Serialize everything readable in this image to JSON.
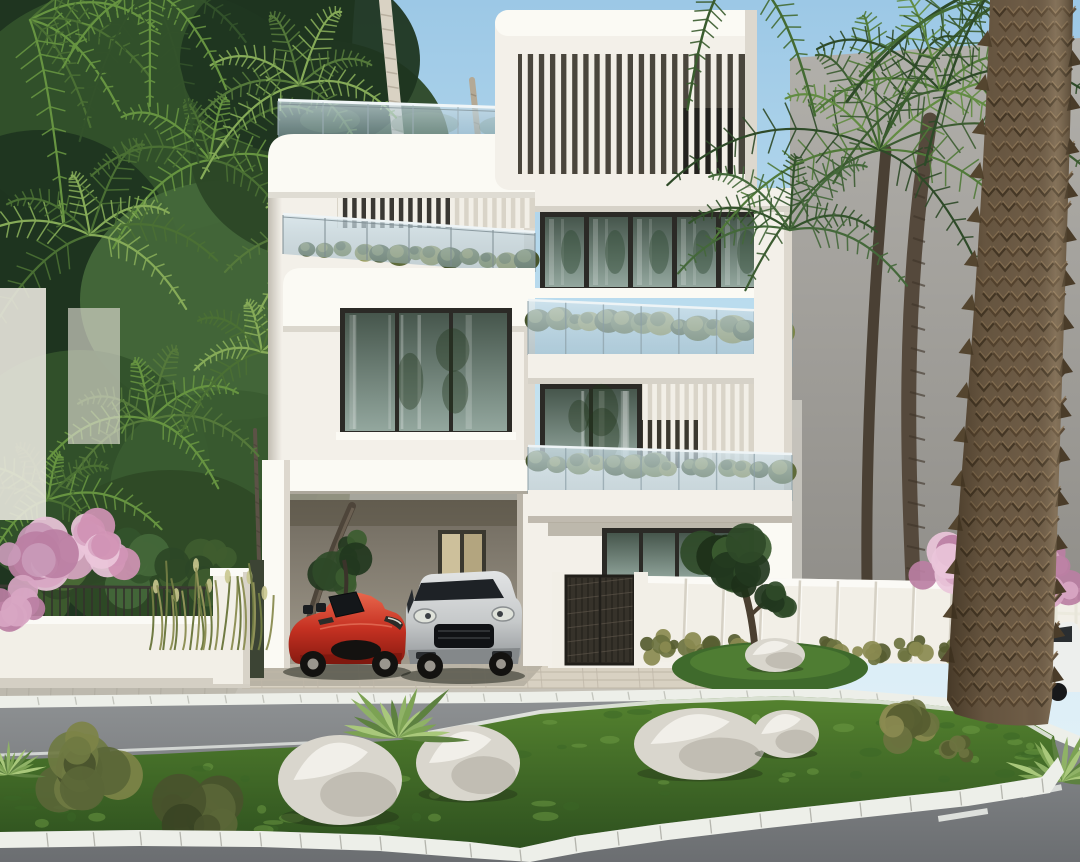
{
  "meta": {
    "description": "Sunny architectural rendering of a modern four-storey white villa with vertical louver screens, glass balconies planted with hedges, a rooftop terrace and a carport sheltering a red convertible and a silver SUV; lush palms surround the house, fronted by a white boundary wall with a dark metal gate, a paver driveway, an asphalt street with white kerbs and a landscaped grass median dotted with white boulders, shrubs and agave; a thick palm trunk rises in the right foreground under a clear blue sky."
  },
  "scene": {
    "sky": {
      "condition": "clear",
      "time": "day"
    },
    "building": {
      "name": "modern-white-villa",
      "storeys": 4,
      "features": [
        "vertical-louver-screens",
        "frameless-glass-balustrades",
        "planted-balcony-hedges",
        "rooftop-terrace",
        "floor-to-ceiling-windows",
        "carport",
        "sliding-glass-doors"
      ]
    },
    "vehicles": [
      {
        "name": "red-convertible",
        "color": "#c53122"
      },
      {
        "name": "silver-suv",
        "color": "#c6c9ca"
      },
      {
        "name": "white-car-across-street",
        "color": "#edefed"
      }
    ],
    "vegetation": [
      "palm-trees",
      "tropical-foliage",
      "pink-bougainvillea",
      "balcony-hedges",
      "agave-plants",
      "lawn-shrubs",
      "garden-tree"
    ],
    "streetscape": [
      "white-boundary-wall",
      "dark-metal-gate",
      "white-panel-fence",
      "paver-driveway",
      "asphalt-road",
      "white-kerb-stones",
      "grass-median",
      "white-boulders"
    ]
  },
  "palette": {
    "sky_top": "#9cc8e6",
    "sky_mid": "#c2e1f0",
    "sky_low": "#dceef7",
    "villa_white": "#f3f0e9",
    "villa_bright": "#fbfaf4",
    "villa_shade": "#ddd8ce",
    "villa_dark": "#b9b3a7",
    "villa_edge": "#c9c3b6",
    "recess_top": "#6f695e",
    "recess_bottom": "#a19a8c",
    "louver_slat": "#f2efe7",
    "louver_bg": "#4a463d",
    "louver_bg_light": "#d9d4c8",
    "window_frame": "#2b2a26",
    "glass_top": "#46564c",
    "glass_bottom": "#93a79e",
    "glass_cool_top": "#5d7680",
    "glass_cool_bottom": "#b7cbd1",
    "balustrade": "#b9d0da",
    "rail": "#64727a",
    "planter_dark": "#46542c",
    "planter_mid": "#5f6b3a",
    "planter_light": "#7b8549",
    "planter_pale": "#96974f",
    "foliage_dark": "#1f3520",
    "foliage_mid": "#33522b",
    "foliage_light": "#4b7034",
    "frond_light": "#679441",
    "frond_pale": "#86ab58",
    "trunk_white": "#d9d2c3",
    "trunk_ring": "#a89f8e",
    "trunk_dark": "#4a4034",
    "fore_trunk": "#6e5c46",
    "fore_trunk_dark": "#423524",
    "fore_trunk_light": "#937c5c",
    "wall_gray_top": "#b2b0ab",
    "wall_gray_bottom": "#8f8d88",
    "fence_white": "#f2efe7",
    "fence_joint": "#d6d1c5",
    "gate_dark": "#36322a",
    "gate_line": "#201e19",
    "pink": "#d8a6c3",
    "pink_light": "#eac6da",
    "pink_deep": "#bb7fa3",
    "road_top": "#8f9294",
    "road_bottom": "#6b6e71",
    "curb": "#edefe9",
    "curb_shade": "#c6c8c2",
    "sidewalk": "#bdb9ae",
    "paver": "#d8d1c2",
    "paver_line": "#bfb7a8",
    "grass_top": "#507c30",
    "grass_bottom": "#2e511f",
    "grass_lit": "#6d9b44",
    "rock_lit": "#f1efe9",
    "rock_mid": "#d9d6cd",
    "rock_shade": "#b3afa4",
    "red_body": "#c53122",
    "red_light": "#e8664c",
    "red_dark": "#871a10",
    "suv_light": "#e2e4e5",
    "suv_mid": "#c6c9ca",
    "suv_dark": "#93979a",
    "car_glass": "#1d2125",
    "white_car": "#edefed",
    "shadow": "#1c2415"
  }
}
